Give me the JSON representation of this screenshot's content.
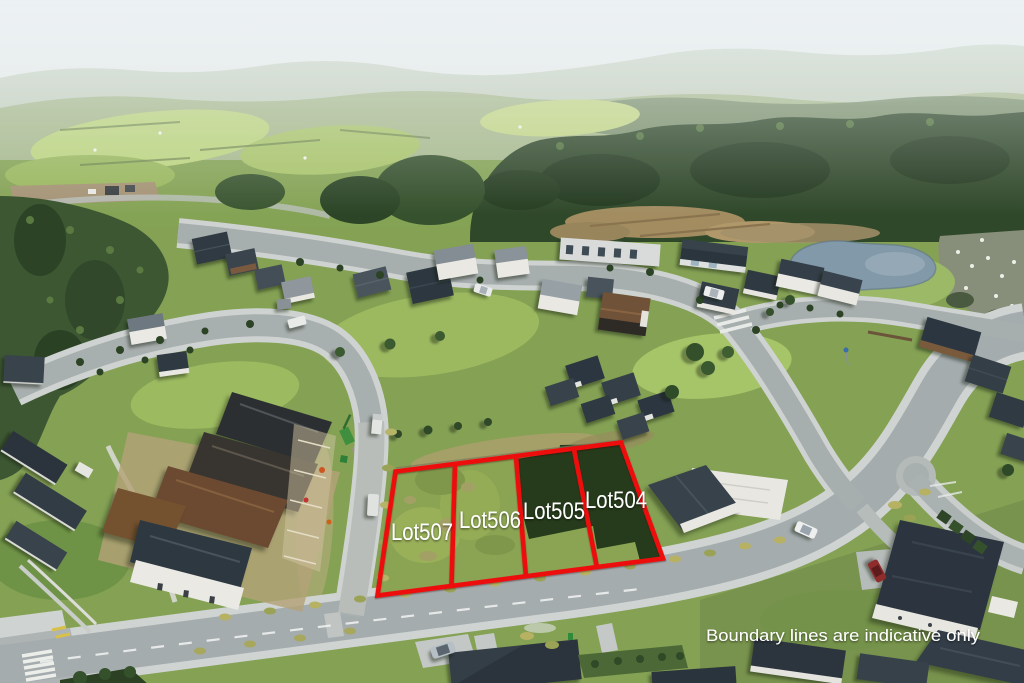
{
  "annotations": {
    "disclaimer": "Boundary lines are indicative only"
  },
  "lots": [
    {
      "label": "Lot507"
    },
    {
      "label": "Lot506"
    },
    {
      "label": "Lot505"
    },
    {
      "label": "Lot504"
    }
  ],
  "colors": {
    "boundary": "#ee1111",
    "label_text": "#ffffff"
  }
}
